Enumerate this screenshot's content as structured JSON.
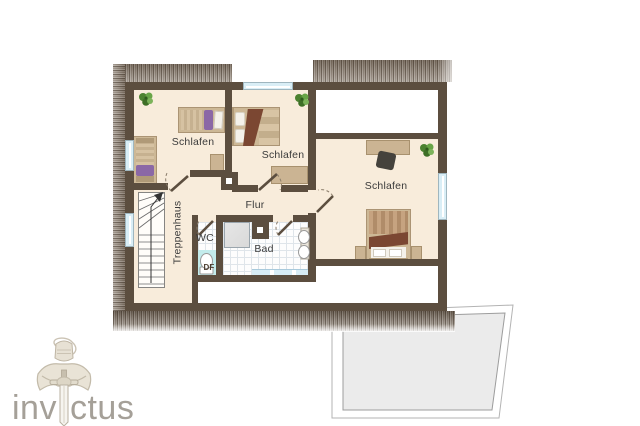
{
  "canvas": {
    "width": 640,
    "height": 426
  },
  "colors": {
    "wall": "#5c4e3f",
    "floor": "#f8ecdb",
    "roof_band": "#94887b",
    "window": "#d9eef6",
    "tile_line": "#dfe5ea",
    "furniture_tan": "#cbb493",
    "blanket_brown": "#7b4732",
    "accent_purple": "#8b68a6",
    "plant_green": "#57963d",
    "shower_gray": "#d9d9d9",
    "toilet_cyan": "#c3ecec",
    "bath_strip_blue": "#d7ecf5",
    "terrace_gray": "#ebebeb",
    "label_text": "#3b3b3b",
    "logo_text": "#a5a098",
    "logo_line": "#cbc3b4"
  },
  "floorplan": {
    "rooms": [
      {
        "id": "bedroom-1",
        "label": "Schlafen"
      },
      {
        "id": "bedroom-2",
        "label": "Schlafen"
      },
      {
        "id": "bedroom-3",
        "label": "Schlafen"
      },
      {
        "id": "hallway",
        "label": "Flur"
      },
      {
        "id": "stairwell",
        "label": "Treppenhaus"
      },
      {
        "id": "wc",
        "label": "WC"
      },
      {
        "id": "bathroom",
        "label": "Bad"
      },
      {
        "id": "roof-window",
        "label": "DF"
      }
    ]
  },
  "logo": {
    "text": "invictus",
    "text_left": "inv",
    "text_right": "ctus"
  }
}
